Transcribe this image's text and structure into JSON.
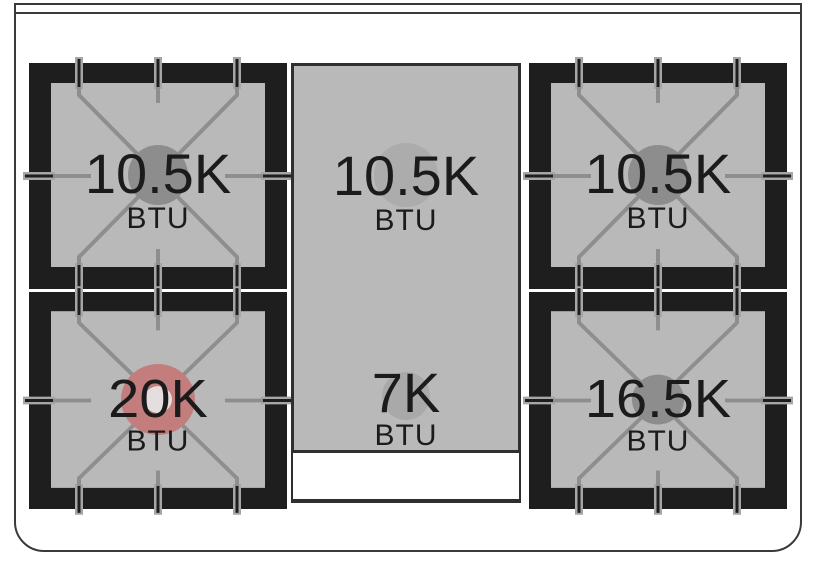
{
  "diagram": {
    "type": "range-cooktop-burner-btu-diagram",
    "unit_label": "BTU"
  },
  "colors": {
    "frame_black": "#1e1e1e",
    "bed_gray": "#b9b9b9",
    "finger_gray": "#8e8e8e",
    "outline_gray": "#3a3a3a",
    "text_black": "#1b1b1b",
    "cap_dark_gray": "#8d8d8d",
    "cap_light_gray": "#acacac",
    "cap_red": "#c47d7d",
    "cap_red_center": "#e5dede",
    "white": "#ffffff"
  },
  "cooktop": {
    "burners": [
      {
        "id": "top-left",
        "value": "10.5K",
        "unit": "BTU",
        "cap_color": "#8d8d8d"
      },
      {
        "id": "top-center",
        "value": "10.5K",
        "unit": "BTU",
        "cap_color": "#acacac"
      },
      {
        "id": "top-right",
        "value": "10.5K",
        "unit": "BTU",
        "cap_color": "#8d8d8d"
      },
      {
        "id": "bottom-left",
        "value": "20K",
        "unit": "BTU",
        "cap_color": "#c47d7d",
        "cap_center_color": "#e5dede"
      },
      {
        "id": "bottom-center",
        "value": "7K",
        "unit": "BTU",
        "cap_color": "#a9a9a9"
      },
      {
        "id": "bottom-right",
        "value": "16.5K",
        "unit": "BTU",
        "cap_color": "#8d8d8d"
      }
    ]
  }
}
